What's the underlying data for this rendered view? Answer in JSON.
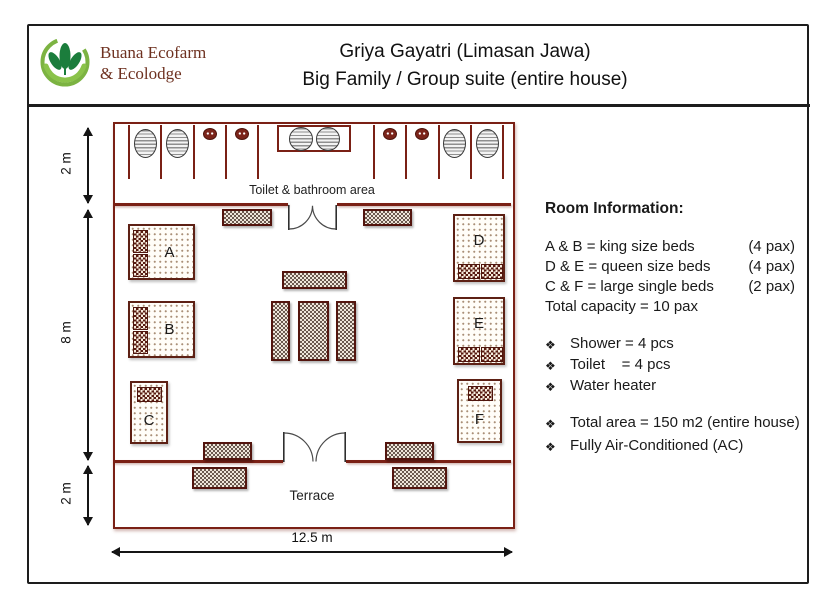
{
  "brand": {
    "line1": "Buana Ecofarm",
    "line2": "& Ecolodge"
  },
  "title": {
    "line1": "Griya Gayatri (Limasan Jawa)",
    "line2": "Big Family / Group suite (entire house)"
  },
  "plan": {
    "toilet_area_label": "Toilet & bathroom area",
    "terrace_label": "Terrace",
    "beds": [
      {
        "label": "A"
      },
      {
        "label": "B"
      },
      {
        "label": "C"
      },
      {
        "label": "D"
      },
      {
        "label": "E"
      },
      {
        "label": "F"
      }
    ],
    "dimensions": {
      "top_depth": "2 m",
      "room_depth": "8 m",
      "terrace_depth": "2 m",
      "total_width": "12.5 m"
    }
  },
  "room_info": {
    "heading": "Room Information:",
    "bed_lines": [
      {
        "text": "A & B = king size beds",
        "pax": "(4 pax)"
      },
      {
        "text": "D & E = queen size beds",
        "pax": "(4 pax)"
      },
      {
        "text": "C & F = large single beds",
        "pax": "(2 pax)"
      }
    ],
    "capacity": "Total capacity = 10 pax",
    "bullet_glyph": "❖",
    "facilities": [
      "Shower = 4 pcs",
      "Toilet    = 4 pcs",
      "Water heater"
    ],
    "extras": [
      "Total area = 150 m2 (entire house)",
      "Fully Air-Conditioned (AC)"
    ]
  },
  "icons": {
    "logo": "buana-ecofarm-leaf-hands-logo",
    "shower": "shower-oval-icon",
    "toilet": "toilet-top-view-icon",
    "washbasin": "washbasin-icon",
    "door": "double-swing-door-icon"
  },
  "colors": {
    "wall": "#7a2015",
    "brand_text": "#6e3120",
    "logo_green_dark": "#1b7d3c",
    "logo_green_light": "#7cb342"
  }
}
